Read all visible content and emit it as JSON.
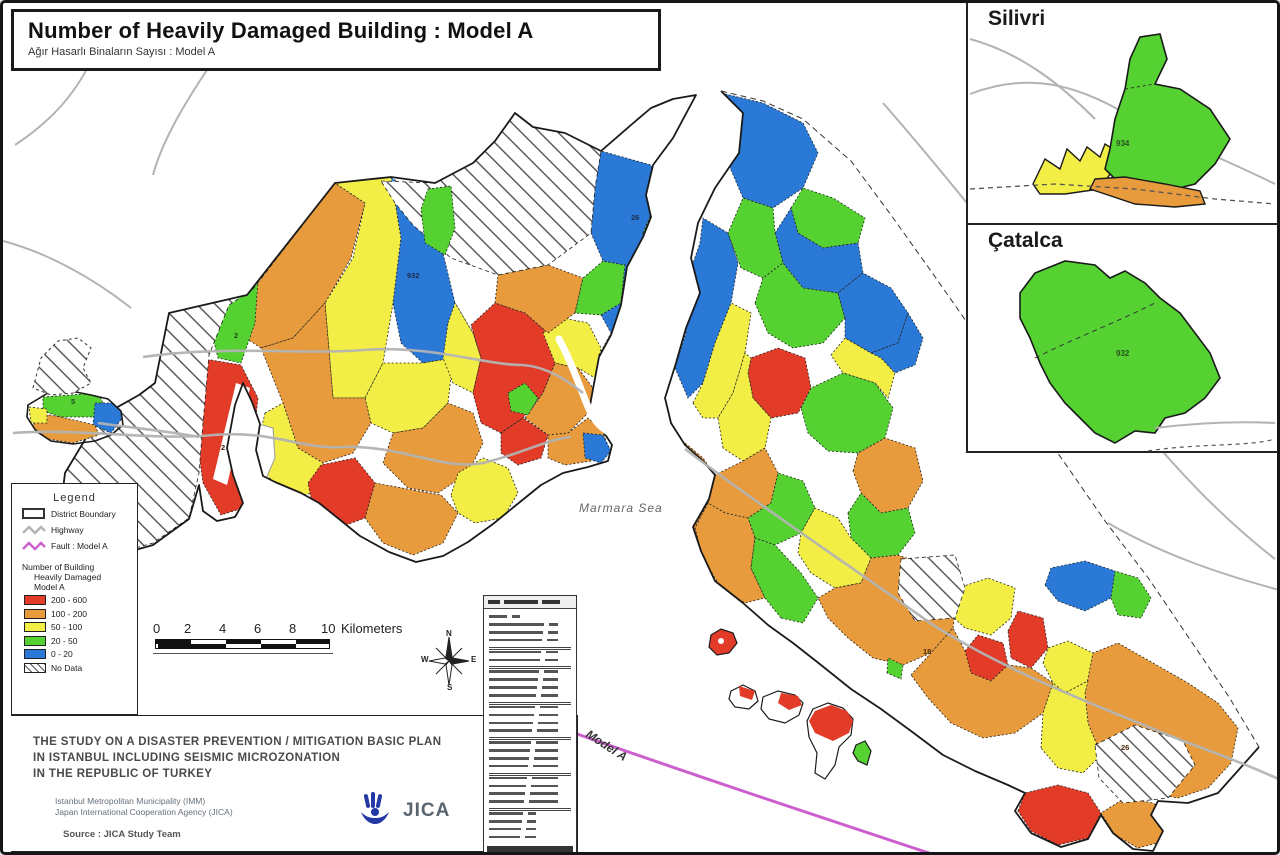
{
  "title": "Number of Heavily Damaged Building : Model A",
  "subtitle": "Ağır Hasarlı Binaların Sayısı : Model A",
  "insets": {
    "silivri": {
      "title": "Silivri",
      "district_value": "934"
    },
    "catalca": {
      "title": "Çatalca",
      "district_value": "932"
    }
  },
  "legend": {
    "title": "Legend",
    "line_items": [
      {
        "label": "District Boundary"
      },
      {
        "label": "Highway",
        "color": "#b3b3b3"
      },
      {
        "label": "Fault : Model A",
        "color": "#cc5fcd"
      }
    ],
    "class_header_lines": [
      "Number of Building",
      "Heavily Damaged",
      "Model A"
    ],
    "classes": [
      {
        "label": "200 - 600",
        "color": "#e23b28"
      },
      {
        "label": "100 - 200",
        "color": "#e79b3c"
      },
      {
        "label": "50 - 100",
        "color": "#f3ee46"
      },
      {
        "label": "20 - 50",
        "color": "#55d232"
      },
      {
        "label": "0 - 20",
        "color": "#2b79d6"
      },
      {
        "label": "No Data",
        "color": "hatch"
      }
    ]
  },
  "scale_bar": {
    "ticks": [
      "0",
      "2",
      "4",
      "6",
      "8",
      "10"
    ],
    "unit": "Kilometers"
  },
  "compass": {
    "n": "N",
    "e": "E",
    "s": "S",
    "w": "W"
  },
  "map_labels": {
    "sea": "Marmara Sea",
    "fault_line": "Model A",
    "districts": {
      "blue_european": "932",
      "green_european": "2",
      "red_european": "2",
      "west_peninsula": "5",
      "north_asian": "26",
      "mid_asian": "18",
      "tuzla": "26"
    }
  },
  "footer": {
    "study_title_lines": [
      "THE STUDY ON A DISASTER PREVENTION / MITIGATION BASIC PLAN",
      "IN ISTANBUL INCLUDING SEISMIC MICROZONATION",
      "IN THE REPUBLIC OF TURKEY"
    ],
    "org_lines": [
      "Istanbul Metropolitan Municipality (IMM)",
      "Japan International Cooperation Agency (JICA)"
    ],
    "source": "Source : JICA Study Team",
    "logo_text": "JICA"
  },
  "side_table": {
    "row_count": 26
  }
}
